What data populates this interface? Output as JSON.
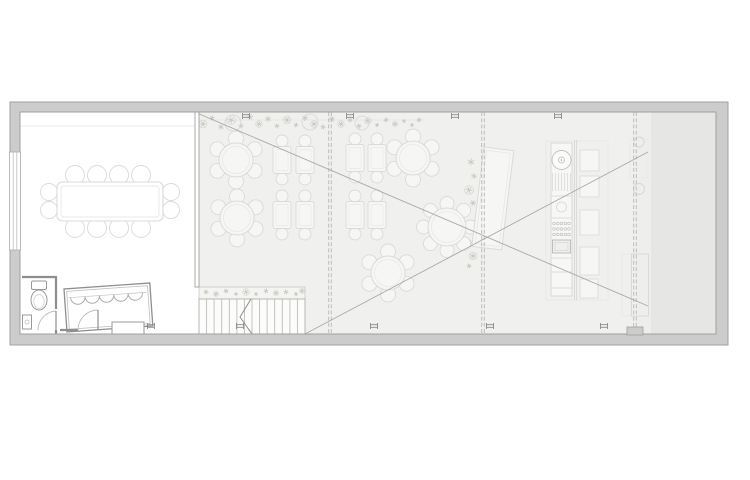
{
  "canvas": {
    "width": 750,
    "height": 480,
    "background": "#ffffff"
  },
  "colors": {
    "wall_fill": "#cccccc",
    "wall_stroke": "#a0a0a0",
    "hall_floor": "#f0f0ef",
    "pocket_floor": "#eeeeec",
    "terrace_floor": "#e6e6e4",
    "line_strong": "#8e8e8e",
    "line_mid": "#bdbdbb",
    "line_light": "#d6d6d4",
    "line_faint": "#e8e8e6",
    "furniture_stroke": "#dadad8",
    "furniture_fill": "#f6f6f5",
    "plant": "#c3c8bc",
    "diagonal": "#a9a9a9",
    "column_marker": "#8a8a8a"
  },
  "plan": {
    "partitions": {
      "y1": 112,
      "y2": 334,
      "xs": [
        330,
        483,
        635
      ]
    },
    "columns": {
      "top": {
        "y": 116,
        "xs": [
          246,
          350,
          455,
          558
        ]
      },
      "bottom": {
        "y": 326,
        "xs": [
          151,
          240,
          374,
          490,
          604
        ]
      }
    },
    "diagonals": [
      [
        197,
        113,
        648,
        306
      ],
      [
        305,
        334,
        648,
        152
      ]
    ],
    "round_tables": [
      {
        "cx": 236,
        "cy": 160,
        "r": 17,
        "chairs": 6
      },
      {
        "cx": 237,
        "cy": 218,
        "r": 17,
        "chairs": 6
      },
      {
        "cx": 413,
        "cy": 158,
        "r": 17,
        "chairs": 6
      },
      {
        "cx": 447,
        "cy": 227,
        "r": 19,
        "chairs": 8
      },
      {
        "cx": 388,
        "cy": 273,
        "r": 17,
        "chairs": 6
      }
    ],
    "rect_tables": {
      "w": 18,
      "h": 27,
      "chair_r": 6,
      "centers": [
        [
          282,
          160
        ],
        [
          305,
          160
        ],
        [
          282,
          215
        ],
        [
          305,
          215
        ],
        [
          355,
          158
        ],
        [
          377,
          158
        ],
        [
          355,
          215
        ],
        [
          377,
          215
        ]
      ]
    },
    "banquet": {
      "x": 57,
      "y": 182,
      "w": 106,
      "h": 39,
      "top_chair_xs": [
        75,
        97,
        119,
        141
      ],
      "end_chair_ys": [
        192,
        210
      ]
    },
    "stairs": {
      "x": 199,
      "y": 299,
      "w": 106,
      "treads": 13,
      "bottom": 334
    },
    "planter": {
      "x": 199,
      "y": 287,
      "w": 106,
      "h": 12
    },
    "plants": [
      [
        203,
        124,
        6
      ],
      [
        212,
        118,
        5
      ],
      [
        221,
        127,
        6
      ],
      [
        231,
        120,
        7
      ],
      [
        241,
        126,
        5
      ],
      [
        250,
        117,
        6
      ],
      [
        259,
        124,
        5
      ],
      [
        268,
        119,
        6
      ],
      [
        277,
        126,
        5
      ],
      [
        287,
        120,
        6
      ],
      [
        296,
        125,
        5
      ],
      [
        305,
        118,
        6
      ],
      [
        314,
        124,
        5
      ],
      [
        323,
        127,
        5
      ],
      [
        332,
        119,
        6
      ],
      [
        341,
        124,
        5
      ],
      [
        350,
        120,
        5
      ],
      [
        359,
        126,
        5
      ],
      [
        368,
        121,
        5
      ],
      [
        377,
        125,
        4
      ],
      [
        386,
        120,
        5
      ],
      [
        395,
        124,
        4
      ],
      [
        404,
        121,
        4
      ],
      [
        412,
        125,
        4
      ],
      [
        419,
        120,
        3
      ],
      [
        471,
        162,
        7
      ],
      [
        474,
        176,
        6
      ],
      [
        469,
        190,
        7
      ],
      [
        473,
        203,
        6
      ],
      [
        470,
        243,
        6
      ],
      [
        473,
        256,
        6
      ],
      [
        469,
        266,
        5
      ],
      [
        206,
        292,
        5
      ],
      [
        216,
        294,
        4
      ],
      [
        226,
        291,
        5
      ],
      [
        236,
        294,
        4
      ],
      [
        246,
        292,
        5
      ],
      [
        256,
        294,
        4
      ],
      [
        266,
        291,
        5
      ],
      [
        276,
        293,
        4
      ],
      [
        286,
        292,
        5
      ],
      [
        296,
        294,
        4
      ],
      [
        302,
        291,
        4
      ]
    ],
    "pots": [
      [
        233,
        123,
        8
      ],
      [
        310,
        122,
        8
      ],
      [
        362,
        123,
        7
      ]
    ],
    "kitchen": {
      "right_units": [
        [
          580,
          150,
          19,
          21
        ],
        [
          580,
          176,
          19,
          21
        ],
        [
          580,
          210,
          19,
          25
        ],
        [
          580,
          247,
          19,
          28
        ],
        [
          580,
          279,
          18,
          19
        ]
      ],
      "hatch": {
        "x": 551,
        "y": 173,
        "w": 21,
        "h": 18,
        "lines": 7
      },
      "dots": {
        "x": 552,
        "y": 221,
        "w": 19,
        "h": 16,
        "rows": 3,
        "cols": 5
      },
      "counter_dividers_y": [
        258,
        272,
        288
      ]
    },
    "bar_scallops": 5
  }
}
